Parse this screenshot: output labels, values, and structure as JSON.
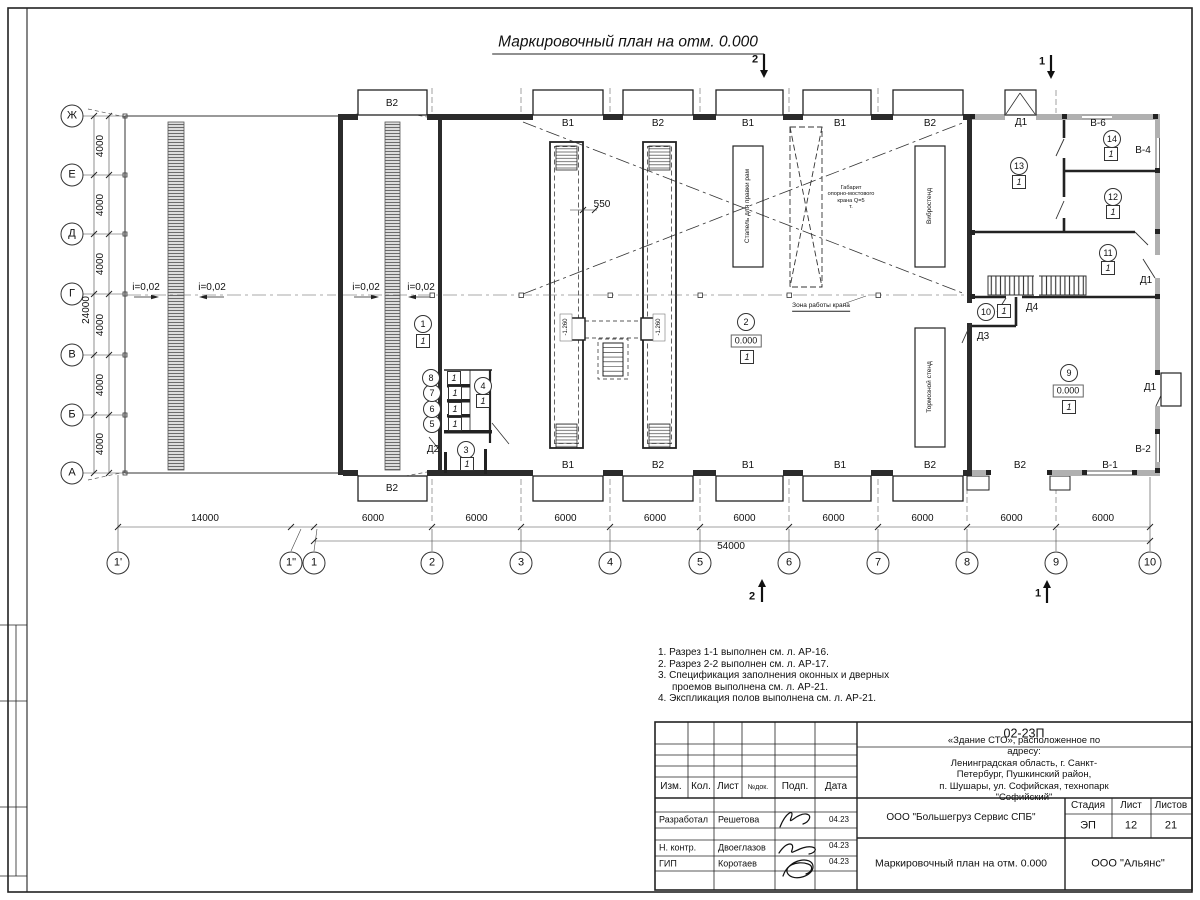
{
  "sheet": {
    "title": "Маркировочный план на отм. 0.000"
  },
  "sections": {
    "s2": "2",
    "s1": "1"
  },
  "axes": {
    "rows": [
      "Ж",
      "Е",
      "Д",
      "Г",
      "В",
      "Б",
      "А"
    ],
    "row_step": "4000",
    "row_total": "24000",
    "cols": [
      "1'",
      "1\"",
      "1",
      "2",
      "3",
      "4",
      "5",
      "6",
      "7",
      "8",
      "9",
      "10"
    ],
    "span_first": "14000",
    "span": "6000",
    "total": "54000"
  },
  "slope": "i=0,02",
  "openings": {
    "top": [
      "В2",
      "В1",
      "В2",
      "В1",
      "В1",
      "В2"
    ],
    "bottom": [
      "В2",
      "В1",
      "В2",
      "В1",
      "В1",
      "В2",
      "В2",
      "В-1"
    ],
    "windows": {
      "v6": "В-6",
      "v4": "В-4",
      "v2": "В-2"
    },
    "doors": {
      "d1": "Д1",
      "d2": "Д2",
      "d3": "Д3",
      "d4": "Д4"
    }
  },
  "equipment": {
    "stapel": "Стапель для правки рам",
    "crane_gauge": "Габарит\nопорно-мостового\nкрана Q=5\nт.",
    "vibro": "Вибростенд",
    "brake": "Тормозной стенд",
    "crane_zone": "Зона работы крана",
    "pit_width": "550",
    "pit_depth": "-1.260"
  },
  "floor_type": "1",
  "elevation": "0.000",
  "rooms": [
    "1",
    "2",
    "3",
    "4",
    "5",
    "6",
    "7",
    "8",
    "9",
    "10",
    "11",
    "12",
    "13",
    "14"
  ],
  "notes": [
    "1. Разрез 1-1 выполнен см. л. АР-16.",
    "2. Разрез 2-2 выполнен см. л. АР-17.",
    "3. Спецификация заполнения оконных и дверных",
    "проемов выполнена см. л. АР-21.",
    "4. Экспликация полов выполнена см. л. АР-21."
  ],
  "titleblock": {
    "code": "02-23П",
    "object": "«Здание СТО», расположенное по адресу:\nЛенинградская область, г. Санкт-Петербург, Пушкинский район,\nп. Шушары, ул. Софийская, технопарк \"Софийский\"",
    "org": "ООО \"Большегруз Сервис СПБ\"",
    "doc_title": "Маркировочный план на отм. 0.000",
    "company": "ООО \"Альянс\"",
    "stage_label": "Стадия",
    "stage": "ЭП",
    "sheet_label": "Лист",
    "sheet": "12",
    "sheets_label": "Листов",
    "sheets": "21",
    "headers": [
      "Изм.",
      "Кол.",
      "Лист",
      "№док.",
      "Подп.",
      "Дата"
    ],
    "signers": [
      {
        "role": "Разработал",
        "name": "Решетова",
        "date": "04.23"
      },
      {
        "role": "Н. контр.",
        "name": "Двоеглазов",
        "date": "04.23"
      },
      {
        "role": "ГИП",
        "name": "Коротаев",
        "date": "04.23"
      }
    ]
  }
}
